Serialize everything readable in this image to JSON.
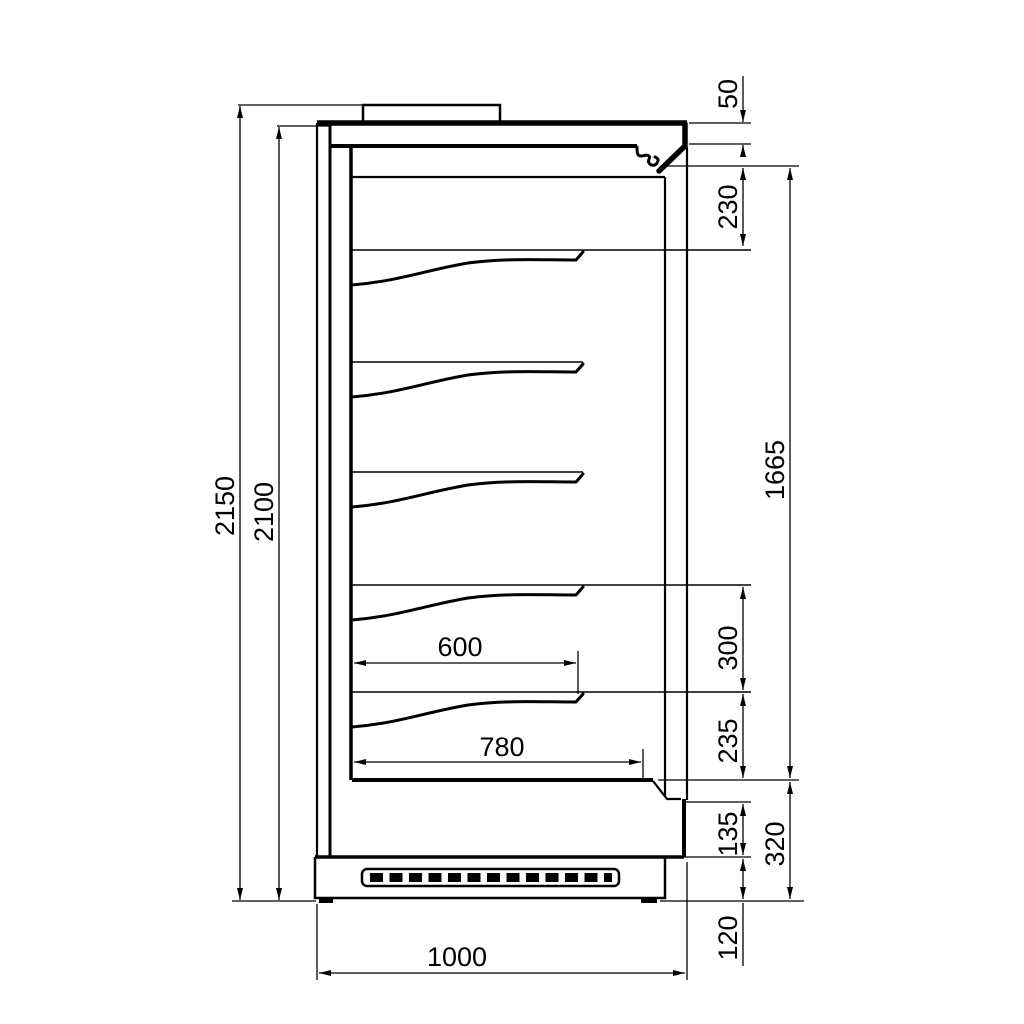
{
  "drawing": {
    "kind": "technical-drawing",
    "dims": {
      "overall_height": "2150",
      "body_height": "2100",
      "canopy_front": "50",
      "top_clearance": "230",
      "interior_opening": "1665",
      "shelf_pitch": "300",
      "bottom_clearance": "235",
      "front_sill": "135",
      "front_base": "320",
      "plinth_height": "120",
      "shelf_depth": "600",
      "deck_depth": "780",
      "overall_depth": "1000"
    }
  }
}
